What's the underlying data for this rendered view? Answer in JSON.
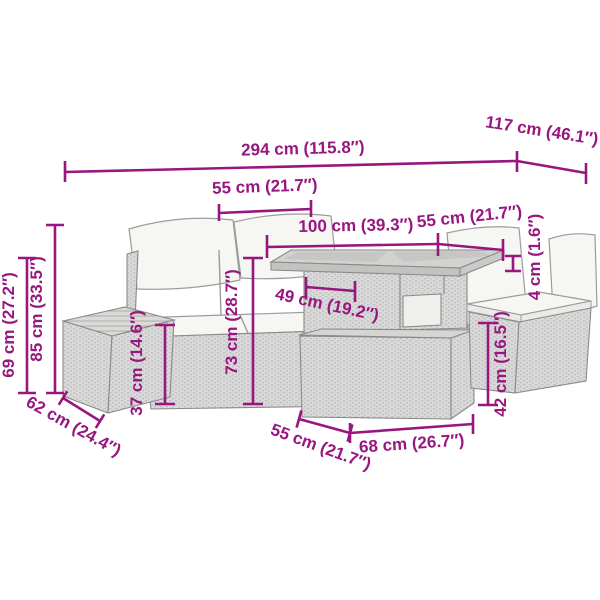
{
  "title": "Rattan garden furniture set — dimension diagram",
  "colors": {
    "dimension_accent": "#97177f",
    "furniture_outline": "#8a8a8a",
    "rattan_fill": "#d8d8d8",
    "cushion_fill": "#f6f6f3"
  },
  "dims": {
    "overall_width": "294 cm (115.8″)",
    "overall_depth": "117 cm (46.1″)",
    "sofa_seat_width": "55 cm (21.7″)",
    "table_length": "100 cm (39.3″)",
    "table_depth": "55 cm (21.7″)",
    "tabletop_thickness": "4 cm (1.6″)",
    "knee_clearance": "49 cm (19.2″)",
    "table_height": "73 cm (28.7″)",
    "seat_height": "37 cm (14.6″)",
    "total_height": "85 cm (33.5″)",
    "seat_unit_height": "69 cm (27.2″)",
    "ottoman_depth": "62 cm (24.4″)",
    "table_base_depth": "55 cm (21.7″)",
    "table_base_width": "68 cm (26.7″)",
    "stool_height": "42 cm (16.5″)"
  }
}
